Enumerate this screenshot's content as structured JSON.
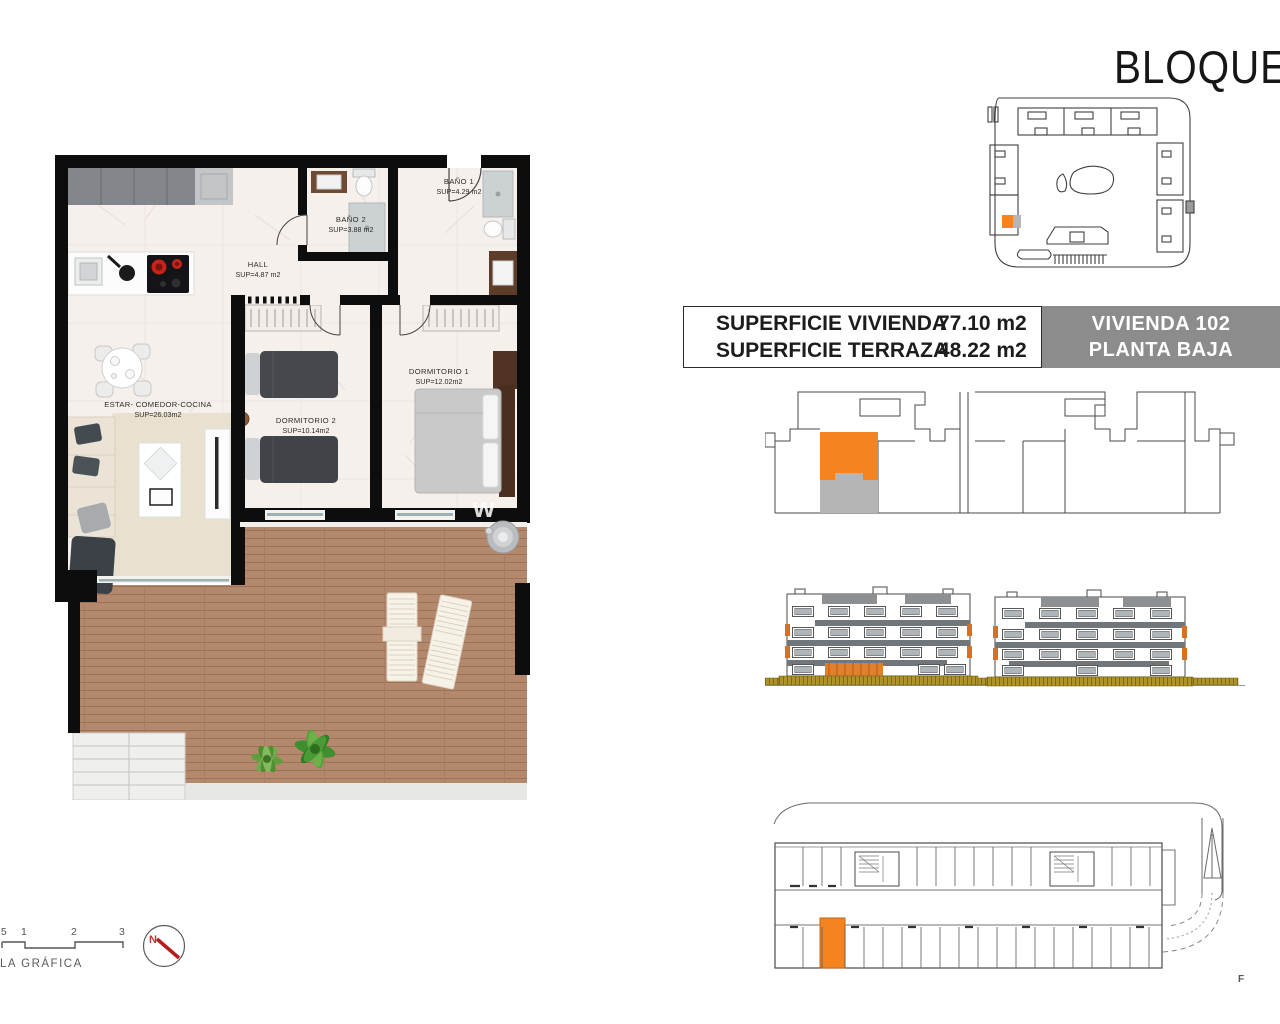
{
  "page": {
    "title": "BLOQUE",
    "corner_mark": "F",
    "watermark": "w"
  },
  "info_table": {
    "rows": [
      {
        "label": "SUPERFICIE VIVIENDA",
        "value": "77.10 m2"
      },
      {
        "label": "SUPERFICIE TERRAZA",
        "value": "48.22 m2"
      }
    ],
    "unit_badge": {
      "line1": "VIVIENDA 102",
      "line2": "PLANTA BAJA"
    }
  },
  "floor_plan": {
    "rooms": [
      {
        "name": "HALL",
        "area": "SUP=4.87  m2"
      },
      {
        "name": "BAÑO  2",
        "area": "SUP=3.88  m2"
      },
      {
        "name": "BAÑO  1",
        "area": "SUP=4.29  m2"
      },
      {
        "name": "DORMITORIO  2",
        "area": "SUP=10.14m2"
      },
      {
        "name": "DORMITORIO  1",
        "area": "SUP=12.02m2"
      },
      {
        "name": "ESTAR-  COMEDOR-COCINA",
        "area": "SUP=26.03m2"
      }
    ]
  },
  "scale_bar": {
    "ticks": [
      ",5",
      "1",
      "2",
      "3"
    ],
    "label": "LA GRÁFICA"
  },
  "compass": {
    "north": "N"
  },
  "colors": {
    "highlight": "#f5831f",
    "terrace": "#b5b5b5",
    "badge_bg": "#8c8c8c",
    "wood": "#b4886c"
  }
}
